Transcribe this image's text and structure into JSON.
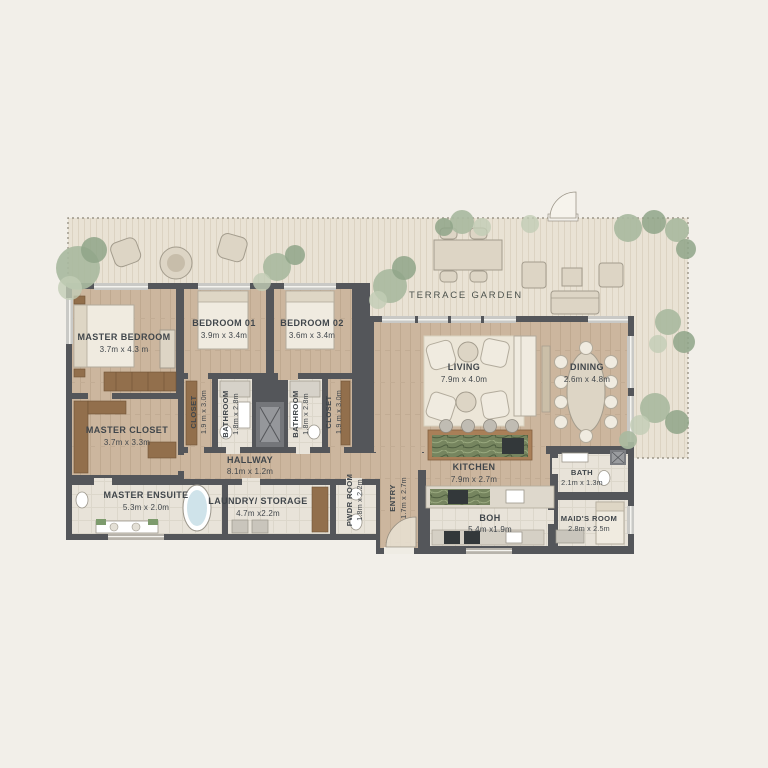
{
  "page": {
    "type": "apartment floor plan",
    "colors": {
      "background": "#f2efe9",
      "wall": "#54565a",
      "wood_floor": "#ccb79f",
      "tile_floor": "#e8e3d9",
      "deck": "#e9e2d4",
      "plant_green": "#a9baa0",
      "marble_green": "#76855f",
      "tub_blue": "#cfe3ea"
    }
  },
  "plan": {
    "terrace": {
      "label": "TERRACE GARDEN"
    },
    "rooms": [
      {
        "name": "MASTER BEDROOM",
        "dims": "3.7m x 4.3 m"
      },
      {
        "name": "BEDROOM 01",
        "dims": "3.9m x 3.4m"
      },
      {
        "name": "BEDROOM 02",
        "dims": "3.6m x 3.4m"
      },
      {
        "name": "CLOSET",
        "dims": "1.9 m x 3.0m"
      },
      {
        "name": "BATHROOM",
        "dims": "1.8m x 2.8m"
      },
      {
        "name": "BATHROOM",
        "dims": "1.8m x 2.8m"
      },
      {
        "name": "CLOSET",
        "dims": "1.9 m x 3.0m"
      },
      {
        "name": "MASTER CLOSET",
        "dims": "3.7m x 3.3m"
      },
      {
        "name": "HALLWAY",
        "dims": "8.1m x 1.2m"
      },
      {
        "name": "MASTER ENSUITE",
        "dims": "5.3m x 2.0m"
      },
      {
        "name": "LAUNDRY/ STORAGE",
        "dims": "4.7m x2.2m"
      },
      {
        "name": "PWDR ROOM",
        "dims": "1.8m x 2.2m"
      },
      {
        "name": "ENTRY",
        "dims": "1.7m x 2.7m"
      },
      {
        "name": "LIVING",
        "dims": "7.9m x 4.0m"
      },
      {
        "name": "DINING",
        "dims": "2.6m x 4.8m"
      },
      {
        "name": "KITCHEN",
        "dims": "7.9m x 2.7m"
      },
      {
        "name": "BOH",
        "dims": "5.4m x1.9m"
      },
      {
        "name": "BATH",
        "dims": "2.1m x 1.3m"
      },
      {
        "name": "MAID'S ROOM",
        "dims": "2.8m x 2.5m"
      }
    ]
  }
}
